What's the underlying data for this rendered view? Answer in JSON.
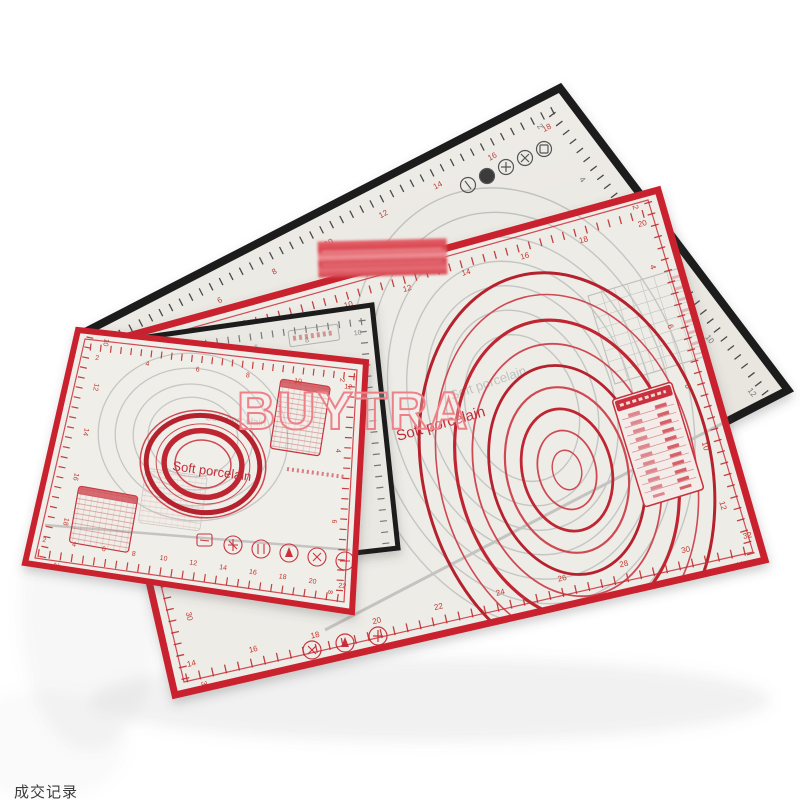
{
  "photo": {
    "description": "product photo of three translucent silicone pastry mats with measuring guides",
    "background_color": "#ffffff",
    "colors": {
      "mat_surface": "#edebe5",
      "black_trim": "#1a1a1a",
      "red_trim": "#c9232e",
      "red_print": "#c0392f",
      "gray_print": "#9b9b9b",
      "censor_red": "#dd4750",
      "watermark_outline": "#ee8187"
    },
    "watermark": {
      "text": "BUYTRA"
    },
    "caption_bottom_left": {
      "text": "成交记录"
    },
    "mats": {
      "black_large": {
        "label": "large black-trim pastry mat",
        "ruler_top": [
          2,
          4,
          6,
          8,
          10,
          12,
          14,
          16,
          18
        ],
        "ruler_right": [
          2,
          4,
          6,
          8,
          10,
          12
        ]
      },
      "red_large": {
        "label": "large red-trim pastry mat",
        "brand_text": "Soft porcelain",
        "unit_label": "cm",
        "ruler_top": [
          2,
          4,
          6,
          8,
          10,
          12,
          14,
          16,
          18,
          20
        ],
        "ruler_right": [
          2,
          4,
          6,
          8,
          10,
          12,
          14
        ],
        "ruler_bottom": [
          14,
          16,
          18,
          20,
          22,
          24,
          26,
          28,
          30,
          32
        ],
        "ruler_left": [
          22,
          24,
          26,
          28,
          30,
          32
        ]
      },
      "black_medium": {
        "label": "medium black-trim pastry mat",
        "ruler_top": [
          2,
          4,
          6,
          8,
          10
        ]
      },
      "red_small": {
        "label": "small red-trim pastry mat",
        "brand_text": "Soft porcelain",
        "unit_label": "cm",
        "ruler_top": [
          2,
          4,
          6,
          8,
          10,
          12
        ],
        "ruler_right": [
          2,
          4,
          6,
          8
        ],
        "ruler_bottom": [
          2,
          4,
          6,
          8,
          10,
          12,
          14,
          16,
          18,
          20,
          22
        ],
        "ruler_left": [
          10,
          12,
          14,
          16,
          18,
          20
        ]
      }
    }
  }
}
